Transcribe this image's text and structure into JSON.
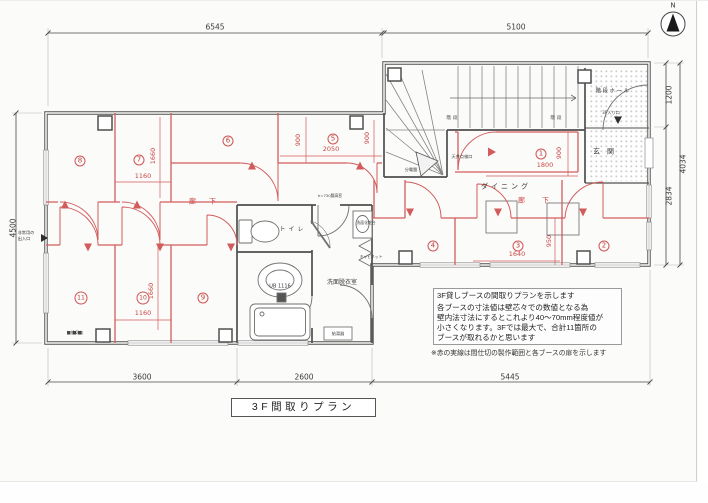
{
  "colors": {
    "partition_red": "#d25c5c",
    "red_text": "#c84848",
    "wall": "#4f4f4f",
    "dim_text": "#3a3a3a"
  },
  "north": {
    "label": "N"
  },
  "title_box": {
    "text": "3F間取りプラン"
  },
  "note_box": {
    "line1": "3F貸しブースの間取りプランを示します",
    "line2": "各ブースの寸法値は壁芯々での数値となる為",
    "line3": "壁内法寸法にするとこれより40〜70mm程度値が",
    "line4": "小さくなります。3Fでは最大で、合計11箇所の",
    "line5": "ブースが取れるかと思います",
    "footnote": "※赤の実線は間仕切の製作範囲と各ブースの扉を示します"
  },
  "rooms": [
    {
      "t": "1",
      "x": 541,
      "y": 154
    },
    {
      "t": "2",
      "x": 604,
      "y": 246
    },
    {
      "t": "3",
      "x": 518,
      "y": 246
    },
    {
      "t": "4",
      "x": 433,
      "y": 246
    },
    {
      "t": "5",
      "x": 333,
      "y": 139
    },
    {
      "t": "6",
      "x": 228,
      "y": 141
    },
    {
      "t": "7",
      "x": 139,
      "y": 160
    },
    {
      "t": "8",
      "x": 80,
      "y": 161
    },
    {
      "t": "9",
      "x": 203,
      "y": 298
    },
    {
      "t": "10",
      "x": 143,
      "y": 298
    },
    {
      "t": "11",
      "x": 81,
      "y": 298
    }
  ],
  "labels": [
    {
      "n": "dim-top-left",
      "t": "6545",
      "x": 215,
      "y": 27,
      "s": 7.5
    },
    {
      "n": "dim-top-right",
      "t": "5100",
      "x": 516,
      "y": 27,
      "s": 7.5
    },
    {
      "n": "dim-left-height",
      "t": "4500",
      "x": 13,
      "y": 228,
      "s": 7.5,
      "r": 1
    },
    {
      "n": "dim-right-upper",
      "t": "1200",
      "x": 669,
      "y": 95,
      "s": 7.5,
      "r": 1
    },
    {
      "n": "dim-right-lower",
      "t": "2834",
      "x": 669,
      "y": 196,
      "s": 7.5,
      "r": 1
    },
    {
      "n": "dim-right-total",
      "t": "4034",
      "x": 683,
      "y": 164,
      "s": 7.5,
      "r": 1
    },
    {
      "n": "dim-bottom-left",
      "t": "3600",
      "x": 142,
      "y": 377,
      "s": 7.5
    },
    {
      "n": "dim-bottom-middle",
      "t": "2600",
      "x": 304,
      "y": 377,
      "s": 7.5
    },
    {
      "n": "dim-bottom-right",
      "t": "5445",
      "x": 510,
      "y": 377,
      "s": 7.5
    },
    {
      "n": "dim-booth7-width",
      "t": "1160",
      "x": 143,
      "y": 176,
      "s": 6.5,
      "c": "red"
    },
    {
      "n": "dim-booth7-depth",
      "t": "1660",
      "x": 153,
      "y": 156,
      "s": 6.5,
      "r": 1,
      "c": "red"
    },
    {
      "n": "dim-booth5-width",
      "t": "2050",
      "x": 331,
      "y": 149,
      "s": 6.5,
      "c": "red"
    },
    {
      "n": "dim-booth5-900",
      "t": "900",
      "x": 298,
      "y": 140,
      "s": 6.5,
      "r": 1,
      "c": "red"
    },
    {
      "n": "dim-corridor-900",
      "t": "900",
      "x": 367,
      "y": 138,
      "s": 6.5,
      "r": 1,
      "c": "red"
    },
    {
      "n": "dim-booth1-900",
      "t": "900",
      "x": 559,
      "y": 153,
      "s": 6.5,
      "r": 1,
      "c": "red"
    },
    {
      "n": "dim-booth1-1800",
      "t": "1800",
      "x": 545,
      "y": 165,
      "s": 6.5,
      "c": "red"
    },
    {
      "n": "dim-booth3-1640",
      "t": "1640",
      "x": 517,
      "y": 254,
      "s": 6.5,
      "c": "red"
    },
    {
      "n": "dim-booth3-950",
      "t": "950",
      "x": 549,
      "y": 241,
      "s": 6.5,
      "r": 1,
      "c": "red"
    },
    {
      "n": "dim-booth10-width",
      "t": "1160",
      "x": 143,
      "y": 313,
      "s": 6.5,
      "c": "red"
    },
    {
      "n": "dim-booth10-depth",
      "t": "1660",
      "x": 151,
      "y": 291,
      "s": 6.5,
      "r": 1,
      "c": "red"
    },
    {
      "n": "room-label-toilet",
      "t": "トイレ",
      "x": 293,
      "y": 230,
      "s": 6,
      "sp": 3
    },
    {
      "n": "room-label-unit-bath",
      "t": "UB 1116",
      "x": 280,
      "y": 287,
      "s": 5
    },
    {
      "n": "room-label-washroom",
      "t": "洗面脱衣室",
      "x": 342,
      "y": 283,
      "s": 6
    },
    {
      "n": "room-label-dining",
      "t": "ダイニング",
      "x": 506,
      "y": 187,
      "s": 7,
      "sp": 3
    },
    {
      "n": "room-label-stair-hall",
      "t": "階段ホール",
      "x": 613,
      "y": 92,
      "s": 5.5,
      "sp": 1.5
    },
    {
      "n": "room-label-genkan",
      "t": "玄関",
      "x": 607,
      "y": 152,
      "s": 7,
      "sp": 7
    },
    {
      "n": "room-label-stair-left",
      "t": "階段",
      "x": 453,
      "y": 119,
      "s": 4.5,
      "sp": 2
    },
    {
      "n": "room-label-stair-right",
      "t": "階段",
      "x": 557,
      "y": 119,
      "s": 4.5,
      "sp": 2
    },
    {
      "n": "room-label-corridor-left",
      "t": "廊下",
      "x": 209,
      "y": 202,
      "s": 7,
      "sp": 13,
      "c": "red"
    },
    {
      "n": "room-label-corridor-right",
      "t": "廊下",
      "x": 542,
      "y": 201,
      "s": 7,
      "sp": 17,
      "c": "red"
    },
    {
      "n": "label-3f-entrance",
      "t": "3F入り口",
      "x": 611,
      "y": 113,
      "s": 4.2
    },
    {
      "n": "label-breaker-panel",
      "t": "分電盤",
      "x": 411,
      "y": 170,
      "s": 4.2
    },
    {
      "n": "label-ceiling-hatch",
      "t": "天井点検口",
      "x": 462,
      "y": 157,
      "s": 4.2
    },
    {
      "n": "label-window-height",
      "t": "h=730腰高窓",
      "x": 330,
      "y": 196,
      "s": 3.8
    },
    {
      "n": "label-cabinet",
      "t": "キャビネット",
      "x": 371,
      "y": 257,
      "s": 3.8
    },
    {
      "n": "label-vanity",
      "t": "洗面化粧台",
      "x": 366,
      "y": 223,
      "s": 3.8
    },
    {
      "n": "label-water-heater",
      "t": "給湯器",
      "x": 338,
      "y": 334,
      "s": 4.2
    },
    {
      "n": "label-vent-fan",
      "t": "換気扇",
      "x": 77,
      "y": 333,
      "s": 4
    },
    {
      "n": "label-emergency-exit-1",
      "t": "非常用の",
      "x": 26,
      "y": 233,
      "s": 4.2
    },
    {
      "n": "label-emergency-exit-2",
      "t": "出入口",
      "x": 24,
      "y": 239,
      "s": 4.2
    },
    {
      "n": "north-letter",
      "t": "N",
      "x": 673,
      "y": 6,
      "s": 7
    }
  ]
}
